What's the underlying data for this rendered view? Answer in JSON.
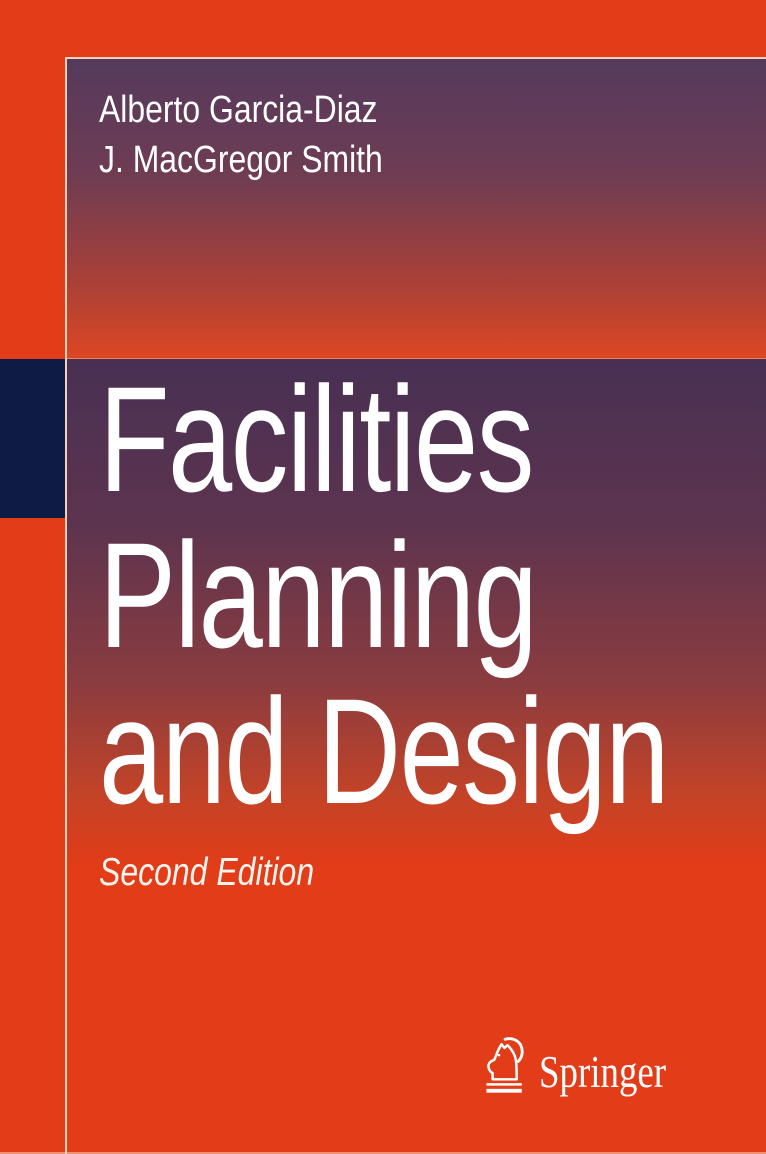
{
  "cover": {
    "authors": [
      "Alberto Garcia-Diaz",
      "J. MacGregor Smith"
    ],
    "title_lines": [
      "Facilities",
      "Planning",
      "and Design"
    ],
    "edition": "Second Edition",
    "publisher": {
      "name": "Springer",
      "logo_icon": "springer-horse-knight-icon"
    },
    "colors": {
      "background_orange": "#e23c18",
      "frame_line": "#f3d0ba",
      "top_panel_gradient_start": "#553a5d",
      "top_panel_gradient_end": "#dc4722",
      "title_panel_gradient_start": "#483053",
      "title_panel_gradient_end": "#e23c18",
      "navy_square": "#0d1b45",
      "text": "#ffffff"
    }
  }
}
